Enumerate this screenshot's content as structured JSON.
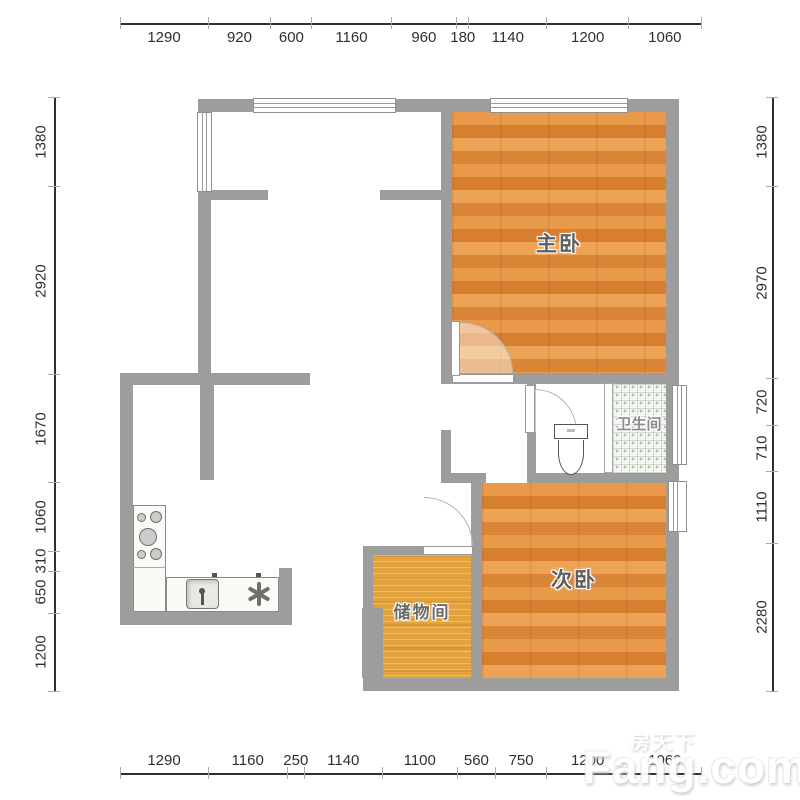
{
  "watermark": {
    "brand": "Fang.com",
    "brand_cn": "房天下"
  },
  "rooms": [
    {
      "id": "master-bedroom",
      "label": "主卧"
    },
    {
      "id": "second-bedroom",
      "label": "次卧"
    },
    {
      "id": "storage-room",
      "label": "储物间"
    },
    {
      "id": "bathroom",
      "label": "卫生间"
    }
  ],
  "dimensions": {
    "top": [
      1290,
      920,
      600,
      1160,
      960,
      180,
      1140,
      1200,
      1060
    ],
    "bottom": [
      1290,
      1160,
      250,
      1140,
      1100,
      560,
      750,
      1200,
      1060
    ],
    "left": [
      1380,
      2920,
      1670,
      1060,
      310,
      650,
      1200
    ],
    "right": [
      1380,
      2970,
      720,
      710,
      1110,
      2280
    ]
  },
  "colors": {
    "wall": "#9d9d9d",
    "wood_floor": "#e08a3e",
    "storage_floor": "#e2a33f",
    "tile_floor": "#f3f6f1",
    "dim_text": "#2f2f2f"
  }
}
